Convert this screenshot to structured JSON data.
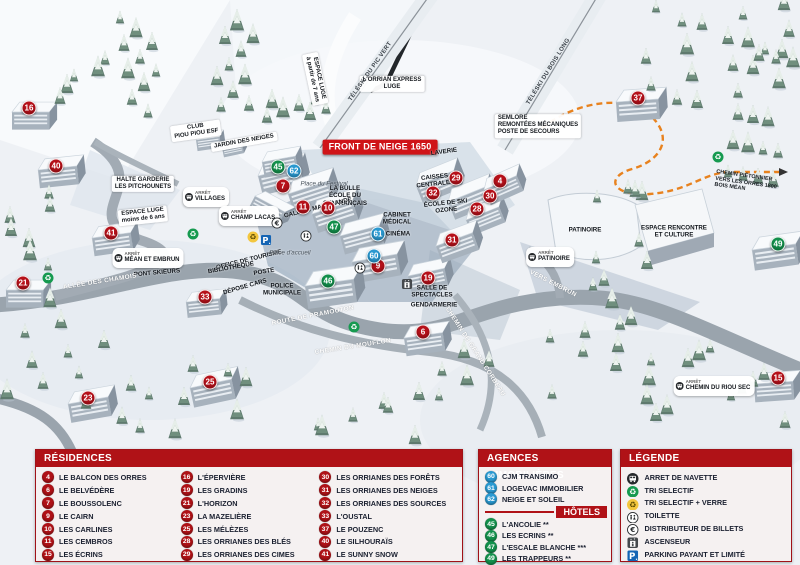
{
  "colors": {
    "header_red": "#b01217",
    "banner_red": "#cf1418",
    "blue": "#2a9ad2",
    "green": "#13914c",
    "panel_bg": "#f5f1f1",
    "text_dark": "#1a2030",
    "orange_trail": "#e8821e"
  },
  "map": {
    "markers": [
      {
        "n": "16",
        "c": "red",
        "x": 29,
        "y": 108
      },
      {
        "n": "40",
        "c": "red",
        "x": 56,
        "y": 166
      },
      {
        "n": "41",
        "c": "red",
        "x": 111,
        "y": 233
      },
      {
        "n": "21",
        "c": "red",
        "x": 23,
        "y": 283
      },
      {
        "n": "33",
        "c": "red",
        "x": 205,
        "y": 297
      },
      {
        "n": "23",
        "c": "red",
        "x": 88,
        "y": 398
      },
      {
        "n": "25",
        "c": "red",
        "x": 210,
        "y": 382
      },
      {
        "n": "7",
        "c": "red",
        "x": 283,
        "y": 186
      },
      {
        "n": "11",
        "c": "red",
        "x": 303,
        "y": 207
      },
      {
        "n": "10",
        "c": "red",
        "x": 328,
        "y": 208
      },
      {
        "n": "9",
        "c": "red",
        "x": 378,
        "y": 266
      },
      {
        "n": "19",
        "c": "red",
        "x": 428,
        "y": 278
      },
      {
        "n": "6",
        "c": "red",
        "x": 423,
        "y": 332
      },
      {
        "n": "29",
        "c": "red",
        "x": 456,
        "y": 178
      },
      {
        "n": "4",
        "c": "red",
        "x": 500,
        "y": 181
      },
      {
        "n": "32",
        "c": "red",
        "x": 433,
        "y": 193
      },
      {
        "n": "30",
        "c": "red",
        "x": 490,
        "y": 196
      },
      {
        "n": "28",
        "c": "red",
        "x": 477,
        "y": 209
      },
      {
        "n": "31",
        "c": "red",
        "x": 452,
        "y": 240
      },
      {
        "n": "37",
        "c": "red",
        "x": 638,
        "y": 98
      },
      {
        "n": "15",
        "c": "red",
        "x": 778,
        "y": 378
      },
      {
        "n": "45",
        "c": "green",
        "x": 278,
        "y": 167
      },
      {
        "n": "47",
        "c": "green",
        "x": 334,
        "y": 227
      },
      {
        "n": "46",
        "c": "green",
        "x": 328,
        "y": 281
      },
      {
        "n": "49",
        "c": "green",
        "x": 778,
        "y": 244
      },
      {
        "n": "62",
        "c": "blue",
        "x": 294,
        "y": 171
      },
      {
        "n": "61",
        "c": "blue",
        "x": 378,
        "y": 234
      },
      {
        "n": "60",
        "c": "blue",
        "x": 374,
        "y": 256
      }
    ],
    "labels": [
      {
        "t": "FRONT DE NEIGE 1650",
        "x": 380,
        "y": 147,
        "k": "banner"
      },
      {
        "t": "L'ORRIAN EXPRESS|LUGE",
        "x": 392,
        "y": 84,
        "k": "box"
      },
      {
        "t": "SEMLORE|REMONTÉES MÉCANIQUES|POSTE DE SECOURS",
        "x": 538,
        "y": 126,
        "k": "box",
        "al": "left"
      },
      {
        "t": "CLUB|PIOU PIOU ESF",
        "x": 196,
        "y": 131,
        "k": "box",
        "r": -8
      },
      {
        "t": "JARDIN DES NEIGES",
        "x": 244,
        "y": 142,
        "k": "box",
        "r": -10
      },
      {
        "t": "ESPACE LUGE|à partir de 7 ans",
        "x": 315,
        "y": 79,
        "k": "box",
        "r": 78
      },
      {
        "t": "ESPACE LUGE|moins de 6 ans",
        "x": 143,
        "y": 216,
        "k": "box",
        "r": -6
      },
      {
        "t": "HALTE GARDERIE|LES PITCHOUNETS",
        "x": 143,
        "y": 184,
        "k": "box"
      },
      {
        "t": "LA BULLE|ÉCOLE DU|SKI FRANÇAIS",
        "x": 345,
        "y": 196,
        "k": "dark"
      },
      {
        "t": "CAISSES|CENTRALES",
        "x": 435,
        "y": 181,
        "k": "dark",
        "r": -6
      },
      {
        "t": "ÉCOLE DE SKI|OZONE",
        "x": 446,
        "y": 207,
        "k": "dark",
        "r": -6
      },
      {
        "t": "CABINET|MÉDICAL",
        "x": 397,
        "y": 219,
        "k": "dark"
      },
      {
        "t": "CINÉMA",
        "x": 398,
        "y": 234,
        "k": "dark"
      },
      {
        "t": "LAVERIE",
        "x": 444,
        "y": 152,
        "k": "dark",
        "r": -8
      },
      {
        "t": "GALERIE MARCHANDE",
        "x": 318,
        "y": 208,
        "k": "dark",
        "r": -14
      },
      {
        "t": "OFFICE DE TOURISME",
        "x": 249,
        "y": 260,
        "k": "dark",
        "r": -14
      },
      {
        "t": "BIBLIOTHÈQUE",
        "x": 231,
        "y": 268,
        "k": "dark",
        "r": -10
      },
      {
        "t": "POSTE",
        "x": 264,
        "y": 272,
        "k": "dark",
        "r": -10
      },
      {
        "t": "DÉPOSE CARS",
        "x": 245,
        "y": 287,
        "k": "dark",
        "r": -16
      },
      {
        "t": "POLICE|MUNICIPALE",
        "x": 282,
        "y": 290,
        "k": "dark"
      },
      {
        "t": "PATINOIRE",
        "x": 585,
        "y": 230,
        "k": "dark"
      },
      {
        "t": "ESPACE RENCONTRE|ET CULTURE",
        "x": 674,
        "y": 232,
        "k": "dark"
      },
      {
        "t": "PONT SKIEURS",
        "x": 157,
        "y": 273,
        "k": "dark",
        "r": -5
      },
      {
        "t": "SALLE DE|SPECTACLES",
        "x": 432,
        "y": 292,
        "k": "dark"
      },
      {
        "t": "GENDARMERIE",
        "x": 434,
        "y": 305,
        "k": "dark"
      },
      {
        "t": "Place du Festival",
        "x": 324,
        "y": 184,
        "k": "it"
      },
      {
        "t": "Place d'accueil",
        "x": 290,
        "y": 253,
        "k": "it"
      },
      {
        "t": "ALLÉE DES CHAMOIS",
        "x": 100,
        "y": 282,
        "k": "road",
        "r": -9
      },
      {
        "t": "ROUTE DE PRAMOUTON",
        "x": 313,
        "y": 316,
        "k": "road",
        "r": -11
      },
      {
        "t": "CHEMIN DU MOUFLON",
        "x": 353,
        "y": 347,
        "k": "road",
        "r": -9
      },
      {
        "t": "CHEMIN DU GRAND CORBEAU",
        "x": 475,
        "y": 352,
        "k": "road",
        "r": 57
      },
      {
        "t": "VERS EMBRUN",
        "x": 553,
        "y": 284,
        "k": "road",
        "r": 27
      },
      {
        "t": "TÉLÉSKI DU PIC VERT",
        "x": 371,
        "y": 72,
        "k": "lift",
        "r": -55
      },
      {
        "t": "TÉLÉSKI DU BOIS LONG",
        "x": 549,
        "y": 72,
        "k": "lift",
        "r": -58
      },
      {
        "t": "CHEMIN PIÉTONNIER|VERS LES ORRES 1800|BOIS MÉAN",
        "x": 746,
        "y": 183,
        "k": "tiny",
        "r": 8,
        "al": "left"
      }
    ],
    "stops": {
      "prefix": "ARRÊT",
      "items": [
        {
          "t": "VILLAGES",
          "x": 206,
          "y": 197
        },
        {
          "t": "CHAMP LACAS",
          "x": 249,
          "y": 216
        },
        {
          "t": "MÉAN ET EMBRUN",
          "x": 148,
          "y": 258
        },
        {
          "t": "PATINOIRE",
          "x": 550,
          "y": 257
        },
        {
          "t": "CHEMIN DU RIOU SEC",
          "x": 714,
          "y": 386
        }
      ]
    },
    "icons": [
      {
        "i": "recycle",
        "x": 193,
        "y": 234
      },
      {
        "i": "recycle",
        "x": 354,
        "y": 327
      },
      {
        "i": "recycle",
        "x": 48,
        "y": 278
      },
      {
        "i": "recycle",
        "x": 718,
        "y": 157
      },
      {
        "i": "recycle-glass",
        "x": 253,
        "y": 237
      },
      {
        "i": "parking",
        "x": 266,
        "y": 240
      },
      {
        "i": "euro",
        "x": 277,
        "y": 223
      },
      {
        "i": "wc",
        "x": 306,
        "y": 236
      },
      {
        "i": "wc",
        "x": 360,
        "y": 268
      },
      {
        "i": "elevator",
        "x": 407,
        "y": 284
      }
    ]
  },
  "panels": {
    "residences": {
      "title": "RÉSIDENCES",
      "columns": [
        [
          {
            "n": "4",
            "label": "LE BALCON DES ORRES"
          },
          {
            "n": "6",
            "label": "LE BELVÉDÈRE"
          },
          {
            "n": "7",
            "label": "LE BOUSSOLENC"
          },
          {
            "n": "9",
            "label": "LE CAIRN"
          },
          {
            "n": "10",
            "label": "LES CARLINES"
          },
          {
            "n": "11",
            "label": "LES CEMBROS"
          },
          {
            "n": "15",
            "label": "LES ÉCRINS"
          }
        ],
        [
          {
            "n": "16",
            "label": "L'ÉPERVIÈRE"
          },
          {
            "n": "19",
            "label": "LES GRADINS"
          },
          {
            "n": "21",
            "label": "L'HORIZON"
          },
          {
            "n": "23",
            "label": "LA MAZELIÈRE"
          },
          {
            "n": "25",
            "label": "LES MÉLÈZES"
          },
          {
            "n": "28",
            "label": "LES ORRIANES DES BLÉS"
          },
          {
            "n": "29",
            "label": "LES ORRIANES DES CIMES"
          }
        ],
        [
          {
            "n": "30",
            "label": "LES ORRIANES DES FORÊTS"
          },
          {
            "n": "31",
            "label": "LES ORRIANES DES NEIGES"
          },
          {
            "n": "32",
            "label": "LES ORRIANES DES SOURCES"
          },
          {
            "n": "33",
            "label": "L'OUSTAL"
          },
          {
            "n": "37",
            "label": "LE POUZENC"
          },
          {
            "n": "40",
            "label": "LE SILHOURAÏS"
          },
          {
            "n": "41",
            "label": "LE SUNNY SNOW"
          }
        ]
      ]
    },
    "agences": {
      "title": "AGENCES IMMOBILIÈRES",
      "items": [
        {
          "n": "60",
          "label": "CJM TRANSIMO"
        },
        {
          "n": "61",
          "label": "LOGEVAC IMMOBILIER"
        },
        {
          "n": "62",
          "label": "NEIGE ET SOLEIL"
        }
      ]
    },
    "hotels": {
      "title": "HÔTELS",
      "items": [
        {
          "n": "45",
          "label": "L'ANCOLIE **"
        },
        {
          "n": "46",
          "label": "LES ECRINS **"
        },
        {
          "n": "47",
          "label": "L'ESCALE BLANCHE ***"
        },
        {
          "n": "49",
          "label": "LES TRAPPEURS **"
        }
      ]
    },
    "legende": {
      "title": "LÉGENDE",
      "items": [
        {
          "icon": "bus",
          "label": "ARRET DE NAVETTE"
        },
        {
          "icon": "recycle",
          "label": "TRI SELECTIF"
        },
        {
          "icon": "recycle-glass",
          "label": "TRI SELECTIF + VERRE"
        },
        {
          "icon": "wc",
          "label": "TOILETTE"
        },
        {
          "icon": "euro",
          "label": "DISTRIBUTEUR DE BILLETS"
        },
        {
          "icon": "elevator",
          "label": "ASCENSEUR"
        },
        {
          "icon": "parking",
          "label": "PARKING PAYANT ET LIMITÉ"
        }
      ]
    }
  }
}
